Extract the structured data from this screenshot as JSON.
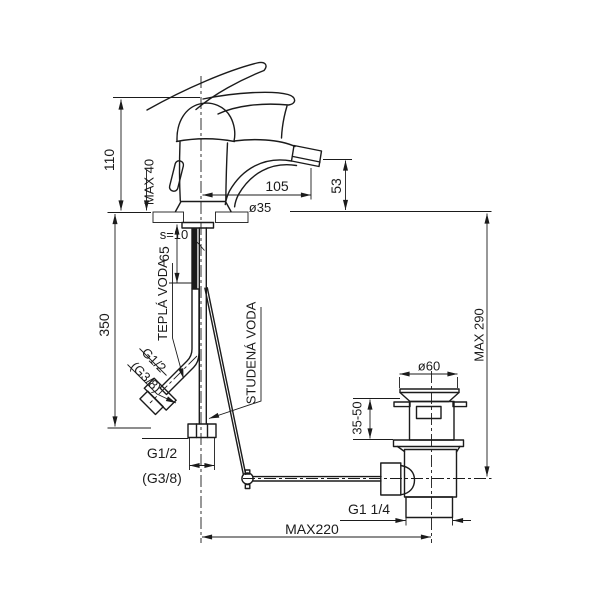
{
  "drawing": {
    "title_hint": "faucet-installation-dimension-drawing",
    "colors": {
      "line": "#1b1b1b",
      "background": "#ffffff"
    },
    "dimensions": {
      "body_height": "110",
      "deck_max_thickness": "MAX 40",
      "spout_reach": "105",
      "spout_height": "53",
      "hole_diameter": "ø35",
      "deck_thickness_shown": "s=10",
      "shank_length": "65",
      "hose_length": "350",
      "rod_max_depth": "MAX 290",
      "waste_flange_diameter": "ø60",
      "clamp_range": "35-50",
      "rod_max_reach": "MAX220"
    },
    "labels": {
      "hot_water": "TEPLÁ VODA",
      "cold_water": "STUDENÁ VODA",
      "hose_thread": "G1/2",
      "hose_thread_alt": "(G3/8)",
      "supply_thread": "G1/2",
      "supply_thread_alt": "(G3/8)",
      "waste_thread": "G1 1/4"
    }
  }
}
